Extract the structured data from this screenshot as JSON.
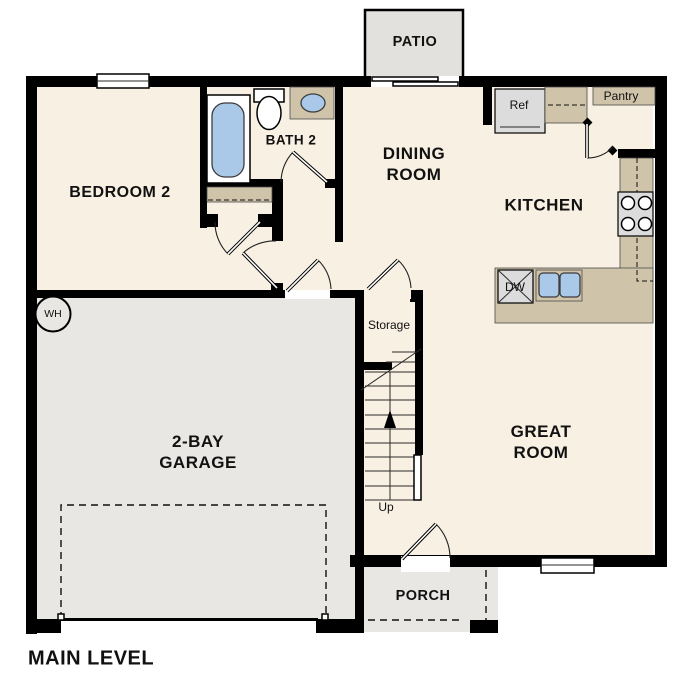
{
  "title": "MAIN LEVEL",
  "colors": {
    "floor": "#f8f0e3",
    "hard": "#e8e7e4",
    "patio": "#e2e1de",
    "counter": "#cfc3a9",
    "fixture_blue": "#aac9e8",
    "appliance": "#dcdcdc",
    "wall": "#000000",
    "window": "#ffffff"
  },
  "rooms": {
    "bedroom2": {
      "label": "BEDROOM 2"
    },
    "bath2": {
      "label": "BATH 2"
    },
    "dining": {
      "line1": "DINING",
      "line2": "ROOM"
    },
    "kitchen": {
      "label": "KITCHEN"
    },
    "great_room": {
      "line1": "GREAT",
      "line2": "ROOM"
    },
    "garage": {
      "line1": "2-BAY",
      "line2": "GARAGE"
    },
    "patio": {
      "label": "PATIO"
    },
    "porch": {
      "label": "PORCH"
    },
    "storage": {
      "label": "Storage"
    }
  },
  "fixtures": {
    "refrigerator": "Ref",
    "pantry": "Pantry",
    "dishwasher": "DW",
    "water_heater": "WH",
    "stairs_direction": "Up"
  }
}
